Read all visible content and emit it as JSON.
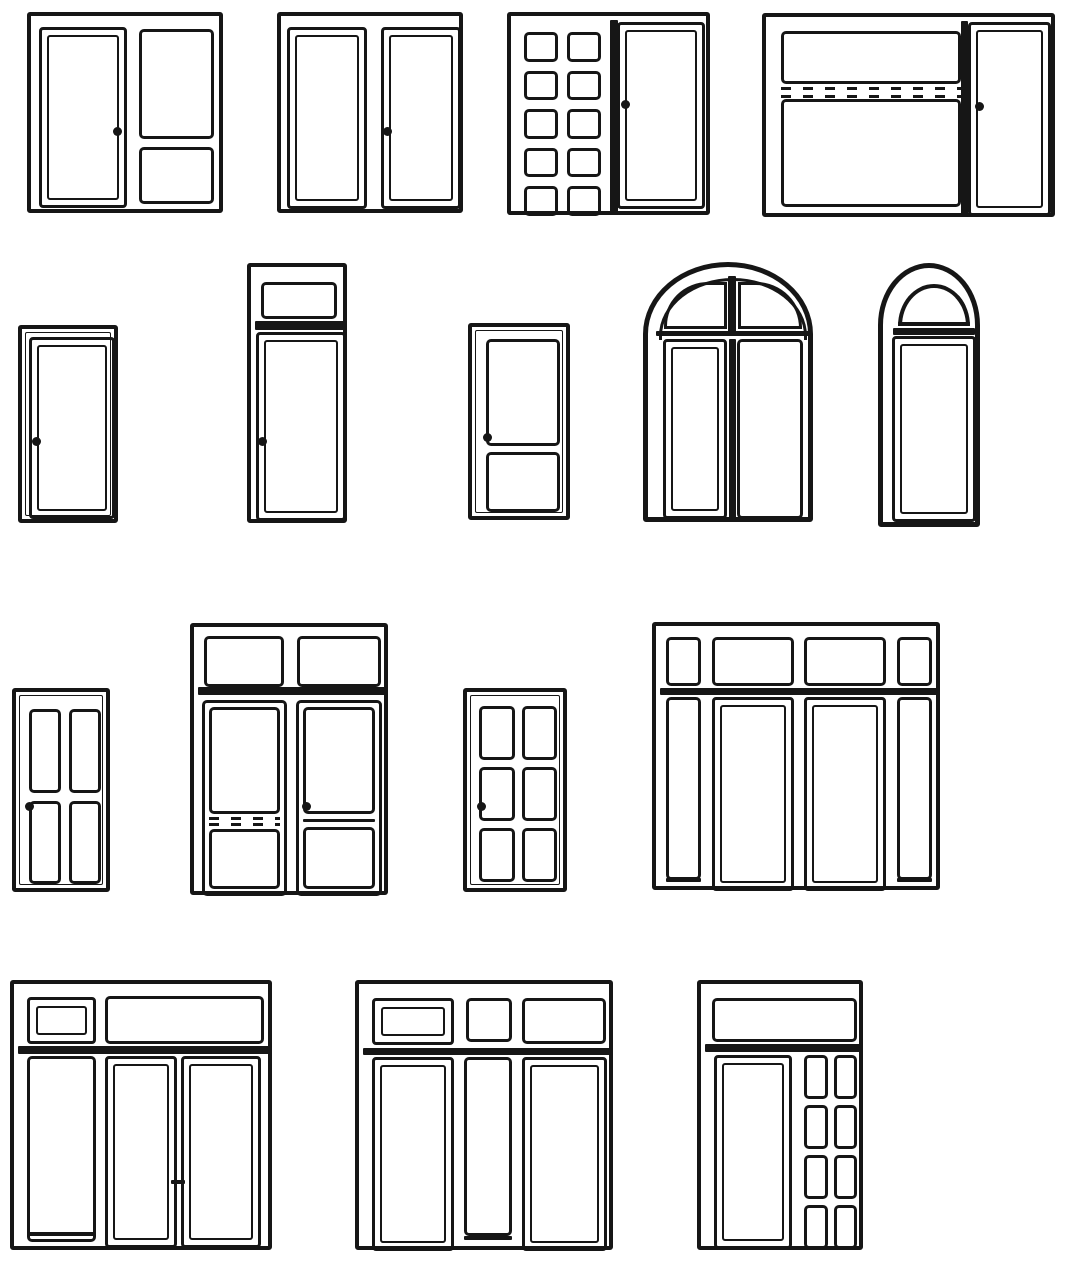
{
  "canvas": {
    "width": 1067,
    "height": 1273,
    "background": "#ffffff",
    "ink": "#161616"
  },
  "diagram": {
    "title": "window-and-door-types-elevation-drawings",
    "rows": 4,
    "drawing_count": 16
  },
  "windows": [
    {
      "name": "casement-with-two-fixed-panes",
      "bbox": [
        27,
        12,
        196,
        201
      ],
      "frame": 4,
      "elements": [
        {
          "t": "sash",
          "r": [
            8,
            11,
            88,
            181
          ]
        },
        {
          "t": "pane",
          "r": [
            108,
            13,
            75,
            110
          ]
        },
        {
          "t": "pane",
          "r": [
            108,
            131,
            75,
            57
          ]
        },
        {
          "t": "dot",
          "c": [
            86,
            115
          ]
        }
      ]
    },
    {
      "name": "double-casement",
      "bbox": [
        277,
        12,
        186,
        201
      ],
      "frame": 4,
      "elements": [
        {
          "t": "sash",
          "r": [
            6,
            11,
            80,
            182
          ]
        },
        {
          "t": "sash",
          "r": [
            100,
            11,
            80,
            182
          ]
        },
        {
          "t": "dot",
          "c": [
            106,
            115
          ]
        }
      ]
    },
    {
      "name": "multipane-grid-and-casement",
      "bbox": [
        507,
        12,
        203,
        203
      ],
      "frame": 4,
      "elements": [
        {
          "t": "grid",
          "r": [
            13,
            16,
            77,
            184
          ],
          "cols": 2,
          "rows": 5,
          "gap": 9
        },
        {
          "t": "bar",
          "r": [
            99,
            4,
            8,
            195
          ]
        },
        {
          "t": "sash",
          "r": [
            106,
            6,
            88,
            187
          ]
        },
        {
          "t": "dot",
          "c": [
            114,
            88
          ]
        }
      ]
    },
    {
      "name": "wide-window-with-vent-strip-and-casement",
      "bbox": [
        762,
        13,
        293,
        204
      ],
      "frame": 4,
      "elements": [
        {
          "t": "pane",
          "r": [
            15,
            14,
            180,
            53
          ]
        },
        {
          "t": "vent",
          "r": [
            15,
            70,
            180,
            11
          ]
        },
        {
          "t": "pane",
          "r": [
            15,
            82,
            180,
            108
          ]
        },
        {
          "t": "bar",
          "r": [
            195,
            4,
            7,
            196
          ]
        },
        {
          "t": "sash",
          "r": [
            202,
            5,
            83,
            194
          ]
        },
        {
          "t": "dot",
          "c": [
            213,
            89
          ]
        }
      ]
    },
    {
      "name": "single-casement",
      "bbox": [
        18,
        325,
        100,
        198
      ],
      "frame": 4,
      "frame2": true,
      "elements": [
        {
          "t": "sash",
          "r": [
            7,
            8,
            86,
            182
          ]
        },
        {
          "t": "dot",
          "c": [
            14,
            112
          ]
        }
      ]
    },
    {
      "name": "casement-with-transom",
      "bbox": [
        247,
        263,
        100,
        260
      ],
      "frame": 4,
      "elements": [
        {
          "t": "pane",
          "r": [
            10,
            15,
            76,
            37
          ]
        },
        {
          "t": "bar",
          "r": [
            4,
            54,
            92,
            9
          ]
        },
        {
          "t": "sash",
          "r": [
            5,
            65,
            90,
            189
          ]
        },
        {
          "t": "dot",
          "c": [
            11,
            174
          ]
        }
      ]
    },
    {
      "name": "door-with-two-panes",
      "bbox": [
        468,
        323,
        102,
        197
      ],
      "frame": 4,
      "frame2": true,
      "elements": [
        {
          "t": "pane",
          "r": [
            14,
            12,
            74,
            107
          ]
        },
        {
          "t": "pane",
          "r": [
            14,
            125,
            74,
            60
          ]
        },
        {
          "t": "dot",
          "c": [
            15,
            110
          ]
        }
      ]
    },
    {
      "name": "arched-double-window",
      "bbox": [
        643,
        262,
        170,
        260
      ],
      "frame": 5,
      "radius": {
        "rx": 85,
        "ry": 72
      },
      "elements": [
        {
          "t": "archband",
          "r": [
            11,
            11,
            148,
            62
          ],
          "rx": 74,
          "ry": 58
        },
        {
          "t": "pane",
          "r": [
            16,
            15,
            63,
            47
          ],
          "rad": [
            44,
            0,
            0,
            0
          ]
        },
        {
          "t": "pane",
          "r": [
            90,
            15,
            64,
            47
          ],
          "rad": [
            0,
            46,
            0,
            0
          ]
        },
        {
          "t": "bar",
          "r": [
            80,
            9,
            8,
            60
          ]
        },
        {
          "t": "bar",
          "r": [
            8,
            64,
            154,
            5
          ]
        },
        {
          "t": "sash",
          "r": [
            15,
            72,
            64,
            180
          ]
        },
        {
          "t": "bar",
          "r": [
            81,
            72,
            7,
            180
          ]
        },
        {
          "t": "pane",
          "r": [
            89,
            72,
            66,
            180
          ]
        }
      ]
    },
    {
      "name": "arched-window-with-fanlight",
      "bbox": [
        878,
        263,
        102,
        264
      ],
      "frame": 5,
      "radius": {
        "rx": 51,
        "ry": 62
      },
      "elements": [
        {
          "t": "fan",
          "r": [
            15,
            16,
            72,
            42
          ]
        },
        {
          "t": "bar",
          "r": [
            10,
            60,
            82,
            7
          ]
        },
        {
          "t": "sash",
          "r": [
            9,
            68,
            84,
            186
          ]
        }
      ]
    },
    {
      "name": "four-pane-window",
      "bbox": [
        12,
        688,
        98,
        204
      ],
      "frame": 4,
      "frame2": true,
      "elements": [
        {
          "t": "grid",
          "r": [
            13,
            17,
            72,
            175
          ],
          "cols": 2,
          "rows": 2,
          "gap": 8
        },
        {
          "t": "dot",
          "c": [
            13,
            114
          ]
        }
      ]
    },
    {
      "name": "double-door-with-transom-and-vent",
      "bbox": [
        190,
        623,
        198,
        272
      ],
      "frame": 4,
      "elements": [
        {
          "t": "pane",
          "r": [
            10,
            9,
            80,
            51
          ]
        },
        {
          "t": "pane",
          "r": [
            103,
            9,
            84,
            51
          ]
        },
        {
          "t": "bar",
          "r": [
            4,
            60,
            190,
            8
          ]
        },
        {
          "t": "pane",
          "r": [
            8,
            73,
            85,
            196
          ]
        },
        {
          "t": "pane",
          "r": [
            15,
            80,
            71,
            107
          ]
        },
        {
          "t": "vent",
          "r": [
            15,
            190,
            71,
            9
          ]
        },
        {
          "t": "pane",
          "r": [
            15,
            202,
            71,
            60
          ]
        },
        {
          "t": "pane",
          "r": [
            102,
            73,
            86,
            196
          ]
        },
        {
          "t": "pane",
          "r": [
            109,
            80,
            72,
            107
          ]
        },
        {
          "t": "bar",
          "r": [
            109,
            192,
            72,
            3
          ]
        },
        {
          "t": "pane",
          "r": [
            109,
            200,
            72,
            62
          ]
        },
        {
          "t": "dot",
          "c": [
            112,
            179
          ]
        }
      ]
    },
    {
      "name": "six-pane-door",
      "bbox": [
        463,
        688,
        104,
        204
      ],
      "frame": 4,
      "frame2": true,
      "elements": [
        {
          "t": "grid",
          "r": [
            12,
            14,
            78,
            176
          ],
          "cols": 2,
          "rows": 3,
          "gap": 7
        },
        {
          "t": "dot",
          "c": [
            14,
            114
          ]
        }
      ]
    },
    {
      "name": "window-wall-with-transoms-and-sidelights",
      "bbox": [
        652,
        622,
        288,
        268
      ],
      "frame": 4,
      "elements": [
        {
          "t": "pane",
          "r": [
            10,
            11,
            35,
            49
          ]
        },
        {
          "t": "pane",
          "r": [
            56,
            11,
            82,
            49
          ]
        },
        {
          "t": "pane",
          "r": [
            148,
            11,
            82,
            49
          ]
        },
        {
          "t": "pane",
          "r": [
            241,
            11,
            35,
            49
          ]
        },
        {
          "t": "bar",
          "r": [
            4,
            62,
            280,
            7
          ]
        },
        {
          "t": "pane",
          "r": [
            10,
            71,
            35,
            183
          ]
        },
        {
          "t": "bar",
          "r": [
            10,
            252,
            35,
            4
          ]
        },
        {
          "t": "sash",
          "r": [
            56,
            71,
            82,
            194
          ]
        },
        {
          "t": "sash",
          "r": [
            148,
            71,
            82,
            194
          ]
        },
        {
          "t": "pane",
          "r": [
            241,
            71,
            35,
            183
          ]
        },
        {
          "t": "bar",
          "r": [
            241,
            252,
            35,
            4
          ]
        }
      ]
    },
    {
      "name": "double-door-with-sidelight-and-transom",
      "bbox": [
        10,
        980,
        262,
        270
      ],
      "frame": 4,
      "elements": [
        {
          "t": "sash",
          "r": [
            13,
            13,
            69,
            47
          ],
          "inset": 6
        },
        {
          "t": "pane",
          "r": [
            91,
            12,
            159,
            48
          ]
        },
        {
          "t": "bar",
          "r": [
            4,
            62,
            254,
            8
          ]
        },
        {
          "t": "pane",
          "r": [
            13,
            72,
            69,
            186
          ]
        },
        {
          "t": "bar",
          "r": [
            13,
            248,
            69,
            4
          ]
        },
        {
          "t": "sash",
          "r": [
            91,
            72,
            72,
            192
          ]
        },
        {
          "t": "sash",
          "r": [
            167,
            72,
            80,
            192
          ]
        },
        {
          "t": "bar",
          "r": [
            157,
            196,
            14,
            4
          ]
        }
      ]
    },
    {
      "name": "door-sidelight-door-with-transoms",
      "bbox": [
        355,
        980,
        258,
        270
      ],
      "frame": 4,
      "elements": [
        {
          "t": "sash",
          "r": [
            13,
            14,
            82,
            47
          ],
          "inset": 6
        },
        {
          "t": "pane",
          "r": [
            107,
            14,
            46,
            44
          ]
        },
        {
          "t": "pane",
          "r": [
            163,
            14,
            84,
            46
          ]
        },
        {
          "t": "bar",
          "r": [
            4,
            64,
            250,
            7
          ]
        },
        {
          "t": "sash",
          "r": [
            13,
            73,
            82,
            194
          ]
        },
        {
          "t": "pane",
          "r": [
            105,
            73,
            48,
            179
          ]
        },
        {
          "t": "bar",
          "r": [
            105,
            252,
            48,
            4
          ]
        },
        {
          "t": "sash",
          "r": [
            163,
            73,
            85,
            194
          ]
        }
      ]
    },
    {
      "name": "door-with-transom-and-multipane-sidelight",
      "bbox": [
        697,
        980,
        166,
        270
      ],
      "frame": 4,
      "elements": [
        {
          "t": "pane",
          "r": [
            11,
            14,
            145,
            44
          ]
        },
        {
          "t": "bar",
          "r": [
            4,
            60,
            158,
            8
          ]
        },
        {
          "t": "sash",
          "r": [
            13,
            71,
            78,
            194
          ]
        },
        {
          "t": "grid",
          "r": [
            103,
            71,
            53,
            194
          ],
          "cols": 2,
          "rows": 4,
          "gap": 6
        }
      ]
    }
  ]
}
